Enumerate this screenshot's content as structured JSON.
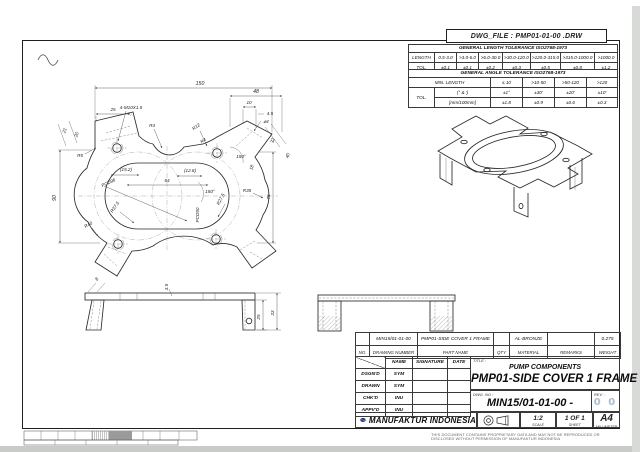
{
  "sheet": {
    "dwg_file": "DWG_FILE : PMP01-01-00 .DRW",
    "footer_note": "THIS DOCUMENT CONTAINS PROPRIETARY DATA  AND MAY NOT BE REPRODUCED OR DISCLOSED WITHOUT PERMISSION OF MANUFAKTUR INDONESIA"
  },
  "tol": {
    "len_title": "GENERAL LENGTH TOLERANCE ISO2768-1973",
    "len_header": "LENGTH",
    "tol_label": "TOL.",
    "len_ranges": [
      "0.5-3.0",
      ">3.0-6.0",
      ">6.0-30.0",
      ">30.0-120.0",
      ">120.0-315.0",
      ">315.0-1000.0",
      ">1000.0"
    ],
    "len_values": [
      "±0.1",
      "±0.1",
      "±0.2",
      "±0.3",
      "±0.5",
      "±0.8",
      "±1.2"
    ],
    "ang_title": "GENERAL ANGLE TOLERANCE ISO2768-1973",
    "ang_header": "MIN. LENGTH",
    "ang_ranges": [
      "≤ 10",
      ">10-50",
      ">50-120",
      ">120"
    ],
    "deg_label": "(° & ')",
    "deg_values": [
      "±1°",
      "±30'",
      "±20'",
      "±10'"
    ],
    "mm_label": "[mm/100mm]",
    "mm_values": [
      "±1.8",
      "±0.9",
      "±0.6",
      "±0.3"
    ]
  },
  "dims": {
    "overall_width": "150",
    "tab_width_48": "48",
    "d10": "10",
    "d45": "4.5",
    "hole4": "⌀4",
    "d25": "25",
    "thread_callout": "4-M10X1.5",
    "r4_top": "R4",
    "r4_lug": "R4",
    "r12": "R12",
    "r5": "R5",
    "d21": "21",
    "d20": "20",
    "height_90": "90",
    "ref_152": "(15.2)",
    "ref_128": "(12.8)",
    "d64": "64",
    "angle_150_right": "150°",
    "angle_150_center": "150°",
    "d18": "18",
    "d32": "32",
    "d40": "40",
    "pcd96": "PCD96",
    "pcd90": "PCD90",
    "r375": "R37.5",
    "r40": "R40",
    "r275": "R27.5",
    "r35": "R35",
    "d75": "75",
    "front_8": "8",
    "front_35": "3.5",
    "front_25": "25",
    "front_33": "33"
  },
  "title_block": {
    "no": "",
    "drawing_number": "MIN15/01-01-00",
    "part_name": "PMP01-SIDE COVER 1 FRAME",
    "qty": "",
    "material": "AL-BRONZE",
    "remarks": "",
    "weight": "0.275",
    "h_no": "NO.",
    "h_drawing_number": "DRAWING NUMBER",
    "h_part_name": "PART NAME",
    "h_qty": "QTY",
    "h_material": "MATERIAL",
    "h_remarks": "REMARKS",
    "h_weight": "WEIGHT",
    "h_name": "NAME",
    "h_signature": "SIGNATURE",
    "h_date": "DATE",
    "rows": [
      {
        "role": "DSGN'D",
        "name": "SYM"
      },
      {
        "role": "DRAWN",
        "name": "SYM"
      },
      {
        "role": "CHK'D",
        "name": "INU"
      },
      {
        "role": "APPV'D",
        "name": "INU"
      }
    ],
    "title_label": "TITLE :",
    "project": "PUMP COMPONENTS",
    "title": "PMP01-SIDE COVER 1 FRAME",
    "dwg_no_label": "DWG. NO :",
    "dwg_no": "MIN15/01-01-00 -",
    "rev_label": "REV. :",
    "rev": "0 0",
    "company": "MANUFAKTUR INDONESIA",
    "scale": "1:2",
    "scale_label": "SCALE",
    "sheet": "1 OF 1",
    "sheet_label": "SHEET",
    "size": "A4",
    "size_label": "MILLIMETER"
  },
  "colors": {
    "ink": "#2b2b2b",
    "logo_navy": "#16306e",
    "rev_blue": "#a9bdd3"
  }
}
